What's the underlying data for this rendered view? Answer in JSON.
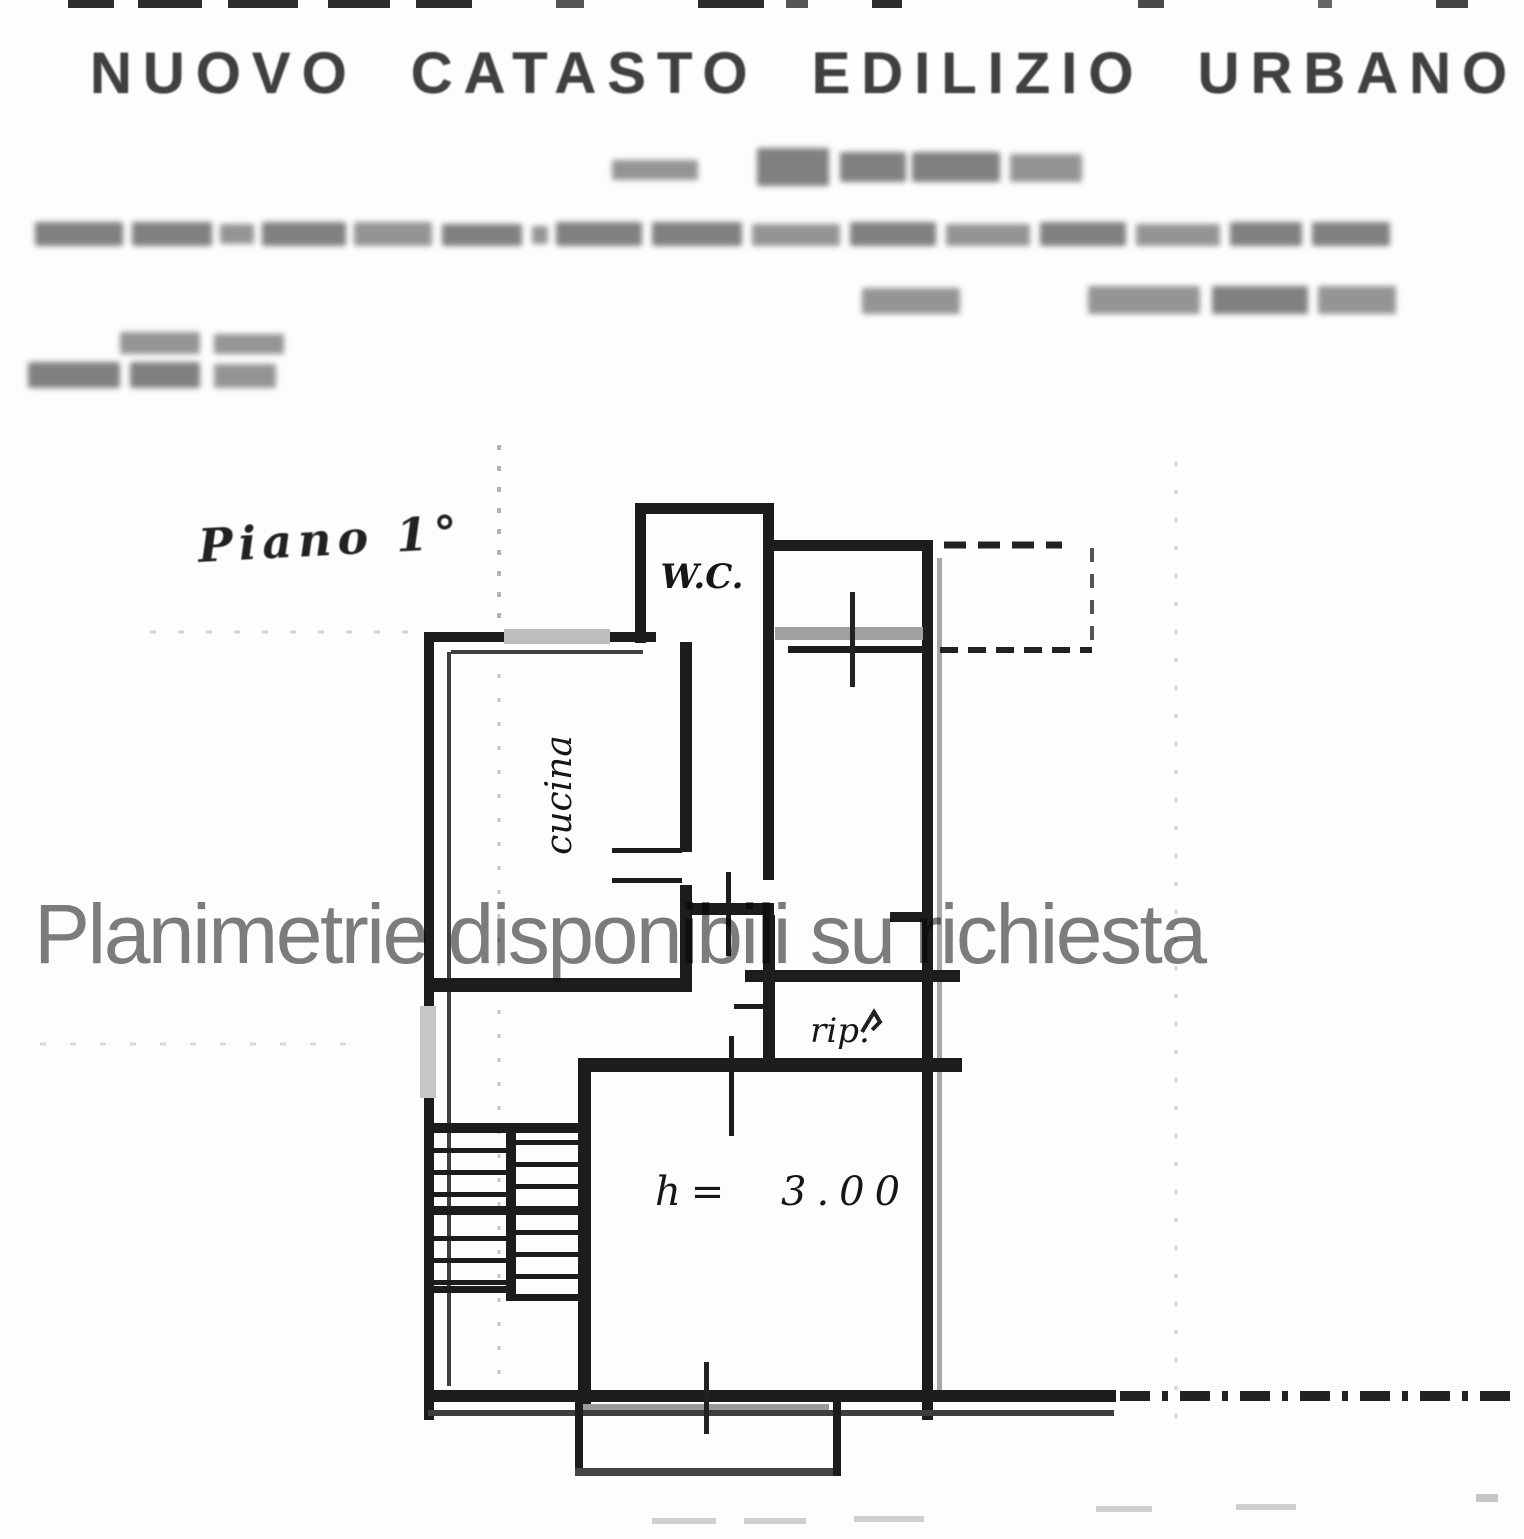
{
  "document": {
    "title": "NUOVO CATASTO EDILIZIO URBANO",
    "watermark": "Planimetrie disponibili su richiesta",
    "floor_label": "Piano 1°",
    "rooms": {
      "wc": "W.C.",
      "kitchen": "cucina",
      "storage": "rip.",
      "ceiling_height": "h= 3.00"
    },
    "colors": {
      "ink": "#1c1c1c",
      "scan_gray": "#9b9b9b",
      "watermark_gray": "#7d7d7d",
      "paper": "#fdfdfd"
    }
  }
}
